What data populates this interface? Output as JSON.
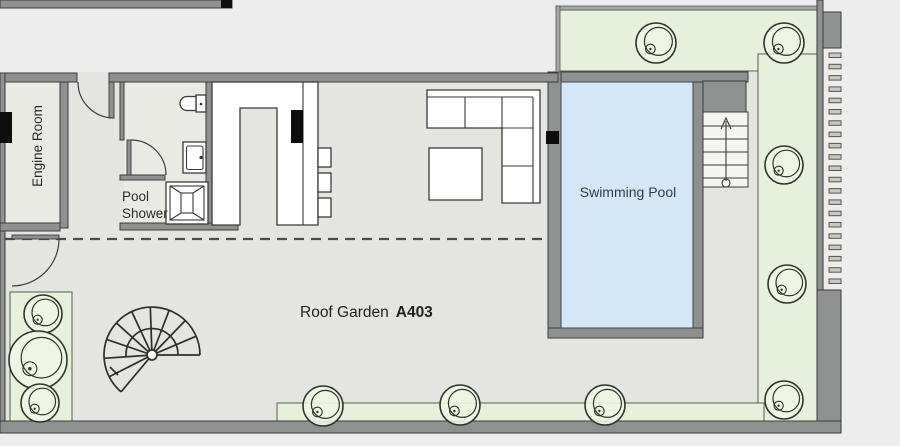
{
  "labels": {
    "engine_room": "Engine Room",
    "pool_shower_line1": "Pool",
    "pool_shower_line2": "Shower",
    "swimming_pool": "Swimming Pool",
    "roof_garden": "Roof Garden",
    "roof_garden_number": "A403"
  },
  "colors": {
    "background": "#ededed",
    "floor": "#e4e5e0",
    "room": "#eaeae5",
    "wall": "#8f9090",
    "outline": "#3b3b3b",
    "green": "#e7f0da",
    "green_line": "#49503f",
    "water": "#d3e7f8",
    "ink": "#2b2b2b"
  },
  "plan": {
    "rooms": [
      "Engine Room",
      "Pool Shower",
      "Kitchen / Living Area",
      "Swimming Pool",
      "Roof Garden A403"
    ],
    "features": [
      "spiral-staircase",
      "pool-stairs",
      "skylight",
      "toilet",
      "basin",
      "sofa",
      "coffee-table",
      "kitchen-island",
      "bar-stools",
      "planters",
      "louver-screen"
    ],
    "plants": [
      {
        "cx": 656,
        "cy": 43,
        "r": 20
      },
      {
        "cx": 784,
        "cy": 43,
        "r": 20
      },
      {
        "cx": 784,
        "cy": 165,
        "r": 19
      },
      {
        "cx": 787,
        "cy": 284,
        "r": 19
      },
      {
        "cx": 784,
        "cy": 400,
        "r": 19
      },
      {
        "cx": 43,
        "cy": 314,
        "r": 19
      },
      {
        "cx": 38,
        "cy": 360,
        "r": 29
      },
      {
        "cx": 40,
        "cy": 403,
        "r": 19
      },
      {
        "cx": 323,
        "cy": 406,
        "r": 20
      },
      {
        "cx": 460,
        "cy": 405,
        "r": 20
      },
      {
        "cx": 605,
        "cy": 405,
        "r": 20
      }
    ],
    "louvers": {
      "x": 829,
      "y_start": 53,
      "step": 11.3,
      "count": 21,
      "width": 12,
      "height": 4.5
    }
  }
}
